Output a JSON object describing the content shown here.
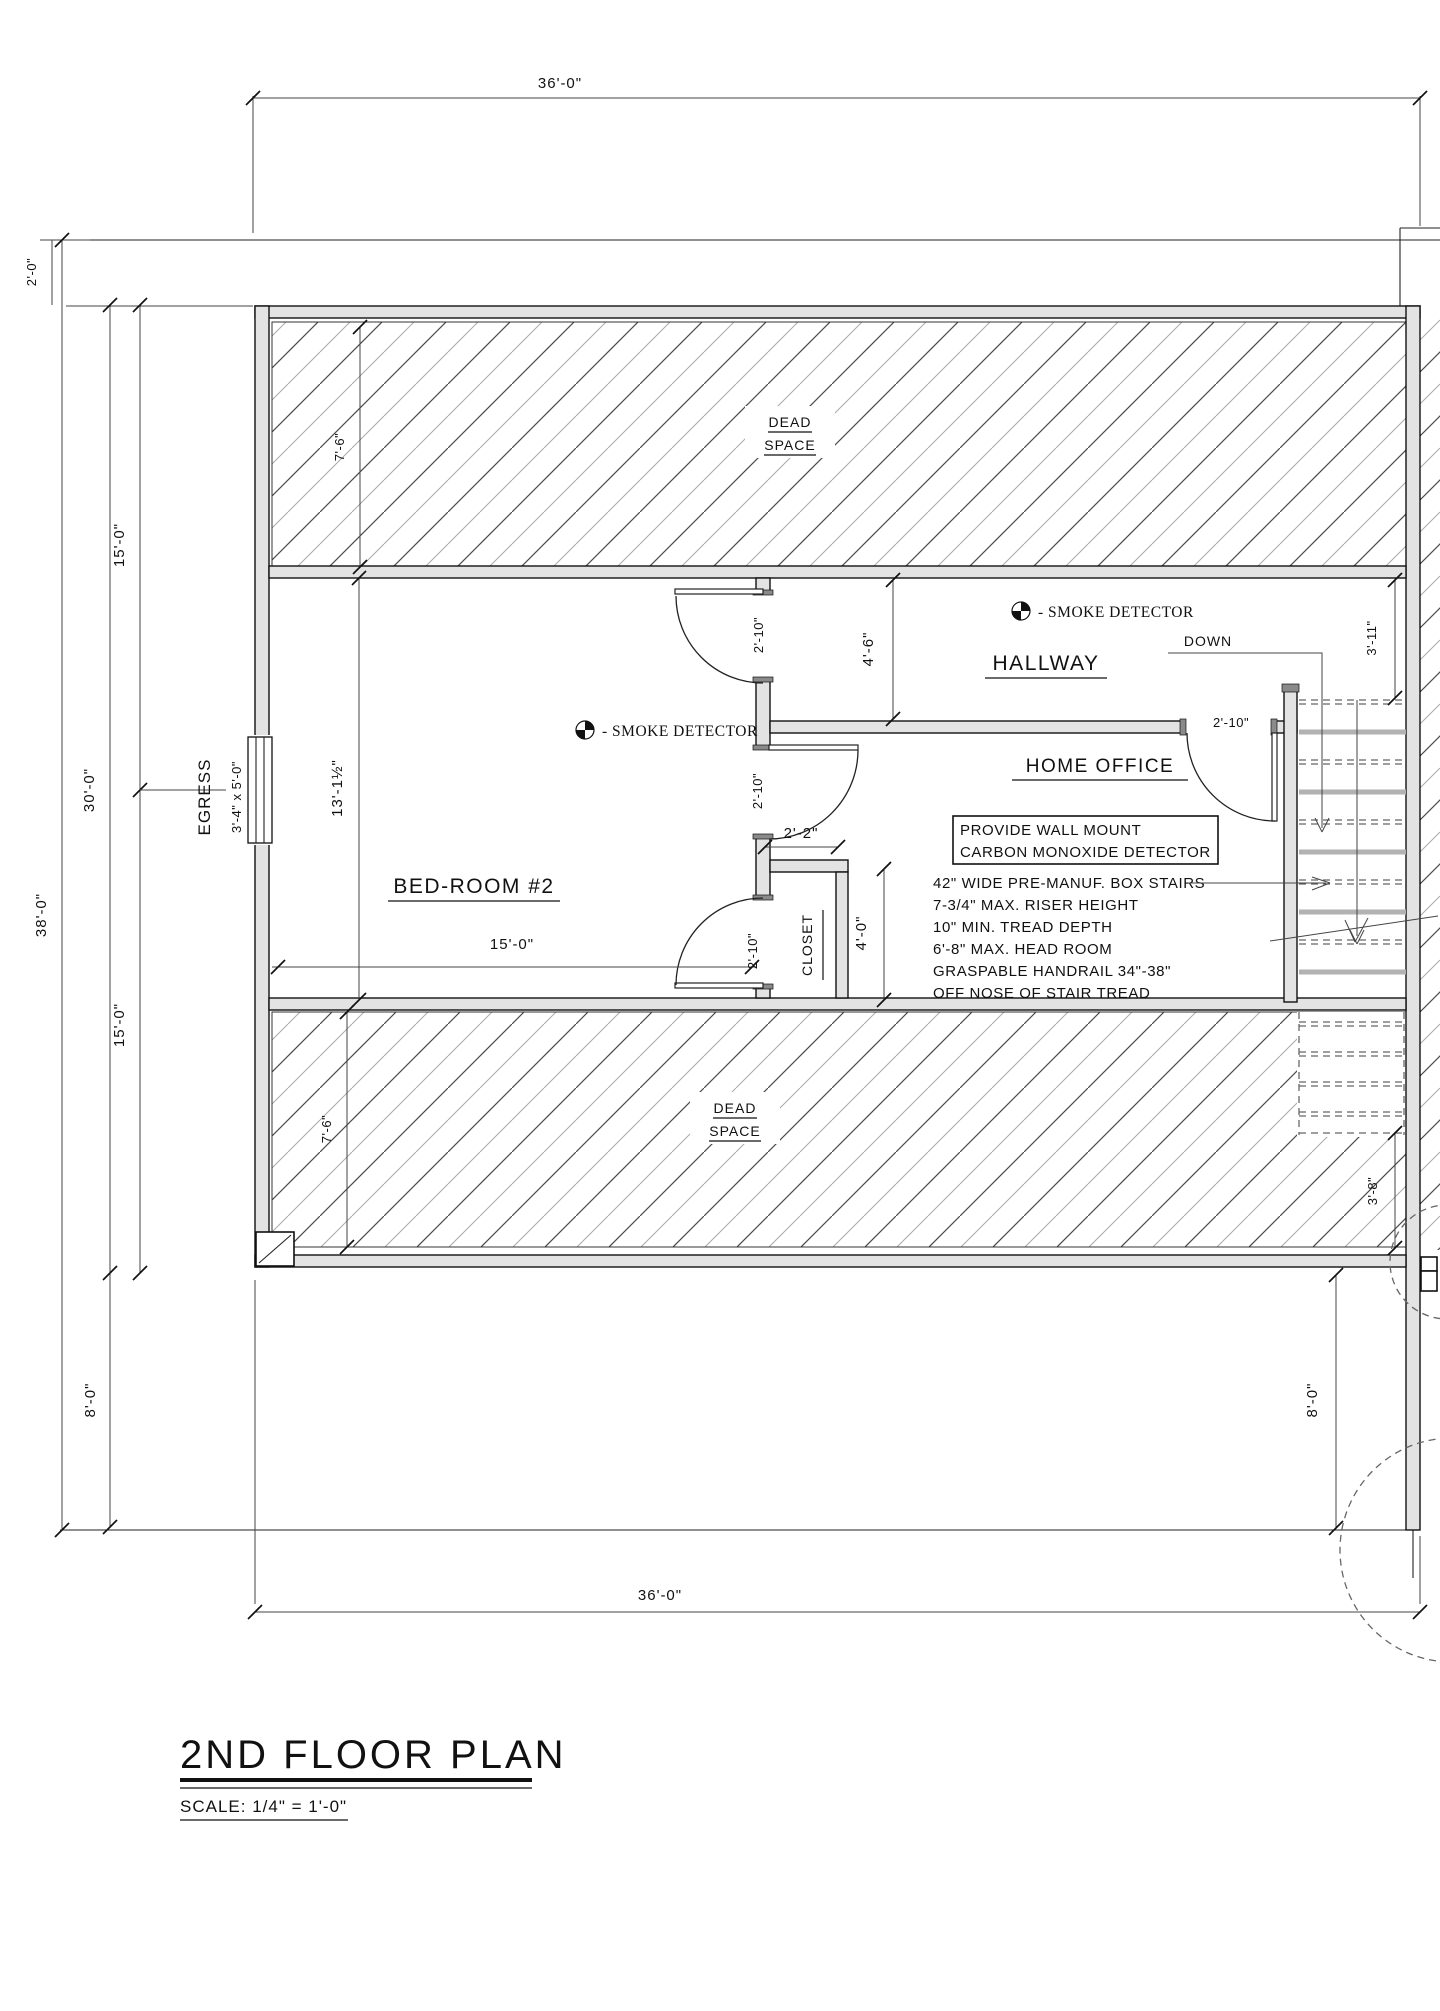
{
  "drawing": {
    "title": "2ND FLOOR PLAN",
    "scale": "SCALE: 1/4\" = 1'-0\""
  },
  "rooms": {
    "bedroom": "BED-ROOM #2",
    "hallway": "HALLWAY",
    "home_office": "HOME OFFICE",
    "closet": "CLOSET",
    "dead_space_line1": "DEAD",
    "dead_space_line2": "SPACE"
  },
  "labels": {
    "egress": "EGRESS",
    "egress_size": "3'-4\" x 5'-0\"",
    "down": "DOWN",
    "smoke_detector": "- SMOKE DETECTOR"
  },
  "notes": {
    "co_line1": "PROVIDE WALL MOUNT",
    "co_line2": "CARBON MONOXIDE DETECTOR",
    "stair_lines": [
      "42\" WIDE PRE-MANUF. BOX STAIRS",
      "7-3/4\" MAX. RISER HEIGHT",
      "10\" MIN. TREAD DEPTH",
      "6'-8\" MAX. HEAD ROOM",
      "GRASPABLE HANDRAIL 34\"-38\"",
      "OFF NOSE OF STAIR TREAD"
    ]
  },
  "dimensions": {
    "overall_width_top": "36'-0\"",
    "overall_width_bottom": "36'-0\"",
    "overall_height": "38'-0\"",
    "interior_height": "30'-0\"",
    "upper_half": "15'-0\"",
    "lower_half": "15'-0\"",
    "roof_overhang": "2'-0\"",
    "lower_roof_left": "8'-0\"",
    "lower_roof_right": "8'-0\"",
    "dead_space_top": "7'-6\"",
    "dead_space_bottom": "7'-6\"",
    "bedroom_height": "13'-1½\"",
    "bedroom_width": "15'-0\"",
    "bedroom_door": "2'-10\"",
    "office_door_west": "2'-10\"",
    "closet_door": "2'-10\"",
    "office_door_east": "2'-10\"",
    "closet_width": "2'-2\"",
    "closet_depth": "4'-0\"",
    "hallway_width": "4'-6\"",
    "stair_top": "3'-11\"",
    "stair_bottom": "3'-8\""
  },
  "colors": {
    "line": "#1a1a1a",
    "wall_fill": "#e3e3e3",
    "dim": "#444444"
  }
}
